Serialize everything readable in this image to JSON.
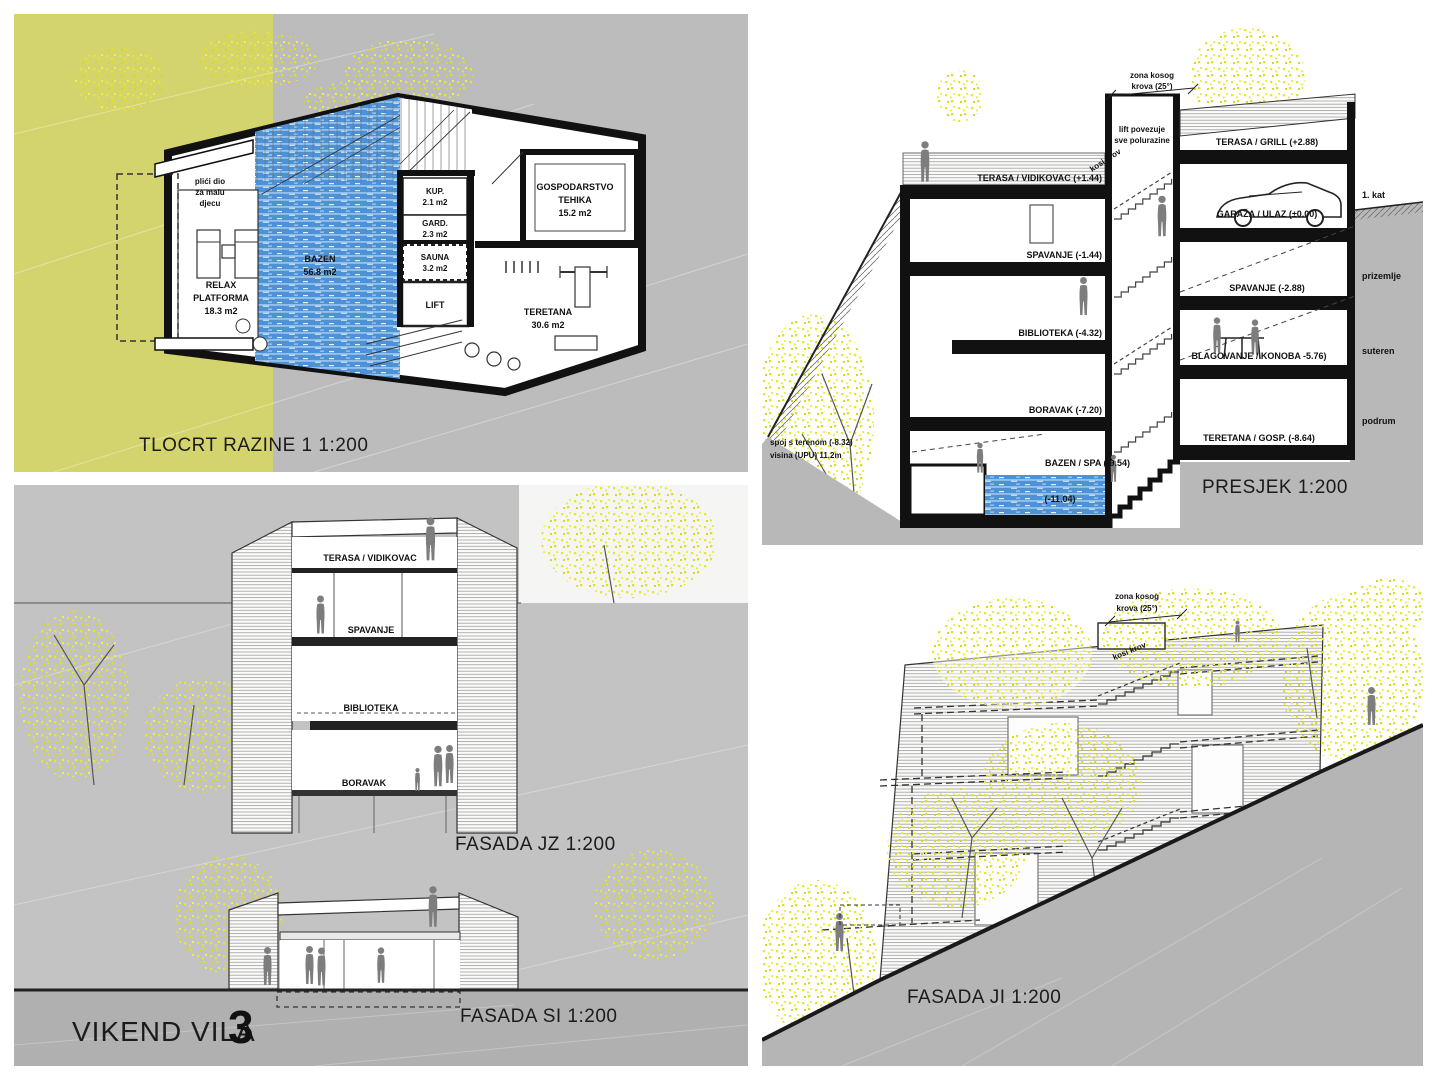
{
  "project": {
    "name": "VIKEND VILA",
    "number": "3"
  },
  "colors": {
    "site_yellow": "#d4d46e",
    "tree_yellow": "#e6e62e",
    "pool_blue": "#4d92d6",
    "panel_gray": "#bdbdbd",
    "slope_gray": "#b2b2b2",
    "ink": "#111111"
  },
  "plan": {
    "title": "TLOCRT RAZINE 1 1:200",
    "shallow_l1": "plići dio",
    "shallow_l2": "za malu",
    "shallow_l3": "djecu",
    "pool_l1": "BAZEN",
    "pool_l2": "56.8 m2",
    "relax_l1": "RELAX",
    "relax_l2": "PLATFORMA",
    "relax_l3": "18.3 m2",
    "kup_l1": "KUP.",
    "kup_l2": "2.1 m2",
    "gard_l1": "GARD.",
    "gard_l2": "2.3 m2",
    "sauna_l1": "SAUNA",
    "sauna_l2": "3.2 m2",
    "lift": "LIFT",
    "gym_l1": "TERETANA",
    "gym_l2": "30.6 m2",
    "utility_l1": "GOSPODARSTVO",
    "utility_l2": "TEHIKA",
    "utility_l3": "15.2 m2"
  },
  "section": {
    "title": "PRESJEK 1:200",
    "roof_zone_l1": "zona kosog",
    "roof_zone_l2": "krova (25°)",
    "lift_note_l1": "lift povezuje",
    "lift_note_l2": "sve polurazine",
    "kosi_krov": "kosi krov",
    "floors_left": [
      "TERASA / VIDIKOVAC (+1.44)",
      "SPAVANJE (-1.44)",
      "BIBLIOTEKA (-4.32)",
      "BORAVAK (-7.20)",
      "BAZEN / SPA (-9.54)",
      "(-11.04)"
    ],
    "floors_right": [
      "TERASA / GRILL (+2.88)",
      "GARAŽA / ULAZ (±0.00)",
      "SPAVANJE (-2.88)",
      "BLAGOVANJE / KONOBA -5.76)",
      "TERETANA / GOSP. (-8.64)"
    ],
    "levels": [
      "1. kat",
      "prizemlje",
      "suteren",
      "podrum"
    ],
    "terrain_l1": "spoj s terenom (-8.32)",
    "terrain_l2": "visina (UPU) 11.2m"
  },
  "facade_jz": {
    "title": "FASADA JZ 1:200",
    "floors": [
      "TERASA / VIDIKOVAC",
      "SPAVANJE",
      "BIBLIOTEKA",
      "BORAVAK"
    ]
  },
  "facade_si": {
    "title": "FASADA SI 1:200"
  },
  "facade_ji": {
    "title": "FASADA JI 1:200",
    "roof_zone_l1": "zona kosog",
    "roof_zone_l2": "krova (25°)",
    "kosi_krov": "kosi krov"
  }
}
